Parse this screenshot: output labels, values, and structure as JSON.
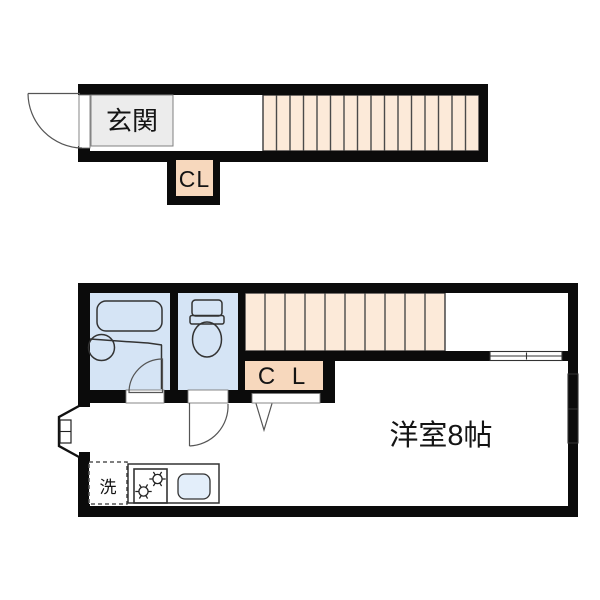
{
  "colors": {
    "wall": "#0b0b0b",
    "stairs": "#fcead9",
    "closet": "#f7d8bd",
    "wet_room": "#d5e4f5",
    "fixture": "#dce9f7",
    "kitchen": "#cfe0f2",
    "sink": "#e3eefa",
    "genkan": "#ececec"
  },
  "floor1": {
    "entrance_label": "玄関",
    "closet_label": "CL"
  },
  "floor2": {
    "closet_label": "C L",
    "room_label": "洋室8帖",
    "laundry_label": "洗"
  }
}
